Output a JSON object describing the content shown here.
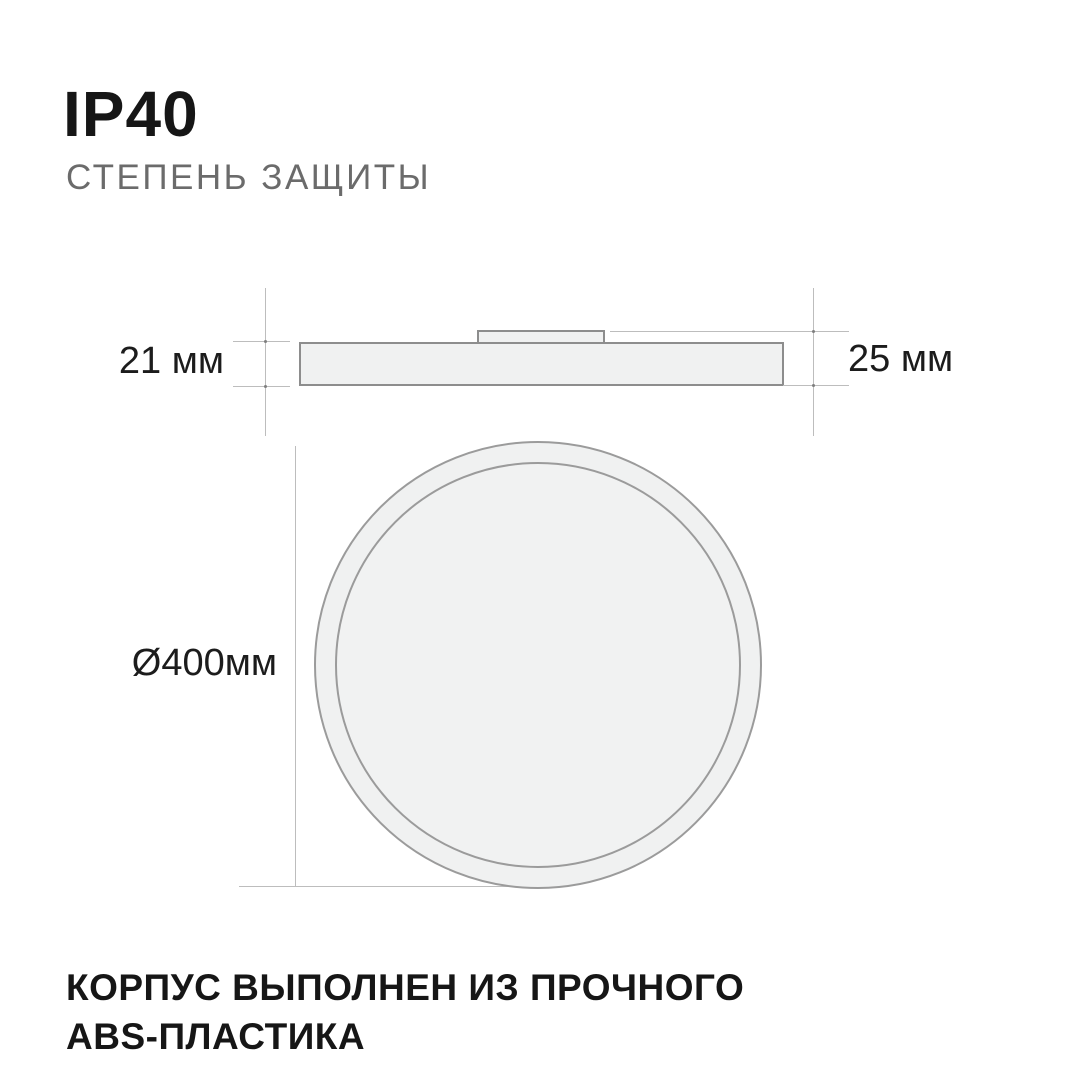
{
  "header": {
    "title": "IP40",
    "subtitle": "СТЕПЕНЬ ЗАЩИТЫ"
  },
  "side_view": {
    "body_height_label": "21 мм",
    "total_height_label": "25 мм"
  },
  "top_view": {
    "diameter_label": "Ø400мм"
  },
  "footer": {
    "line1": "КОРПУС ВЫПОЛНЕН ИЗ ПРОЧНОГО",
    "line2": "ABS-ПЛАСТИКА"
  },
  "colors": {
    "background": "#ffffff",
    "text_primary": "#161616",
    "text_secondary": "#6b6b6b",
    "shape_fill": "#f0f1f1",
    "shape_border": "#8d8d8d",
    "circle_border": "#9b9b9b",
    "dimension_line": "#bdbdbd",
    "dimension_dot": "#7f7f7f"
  }
}
